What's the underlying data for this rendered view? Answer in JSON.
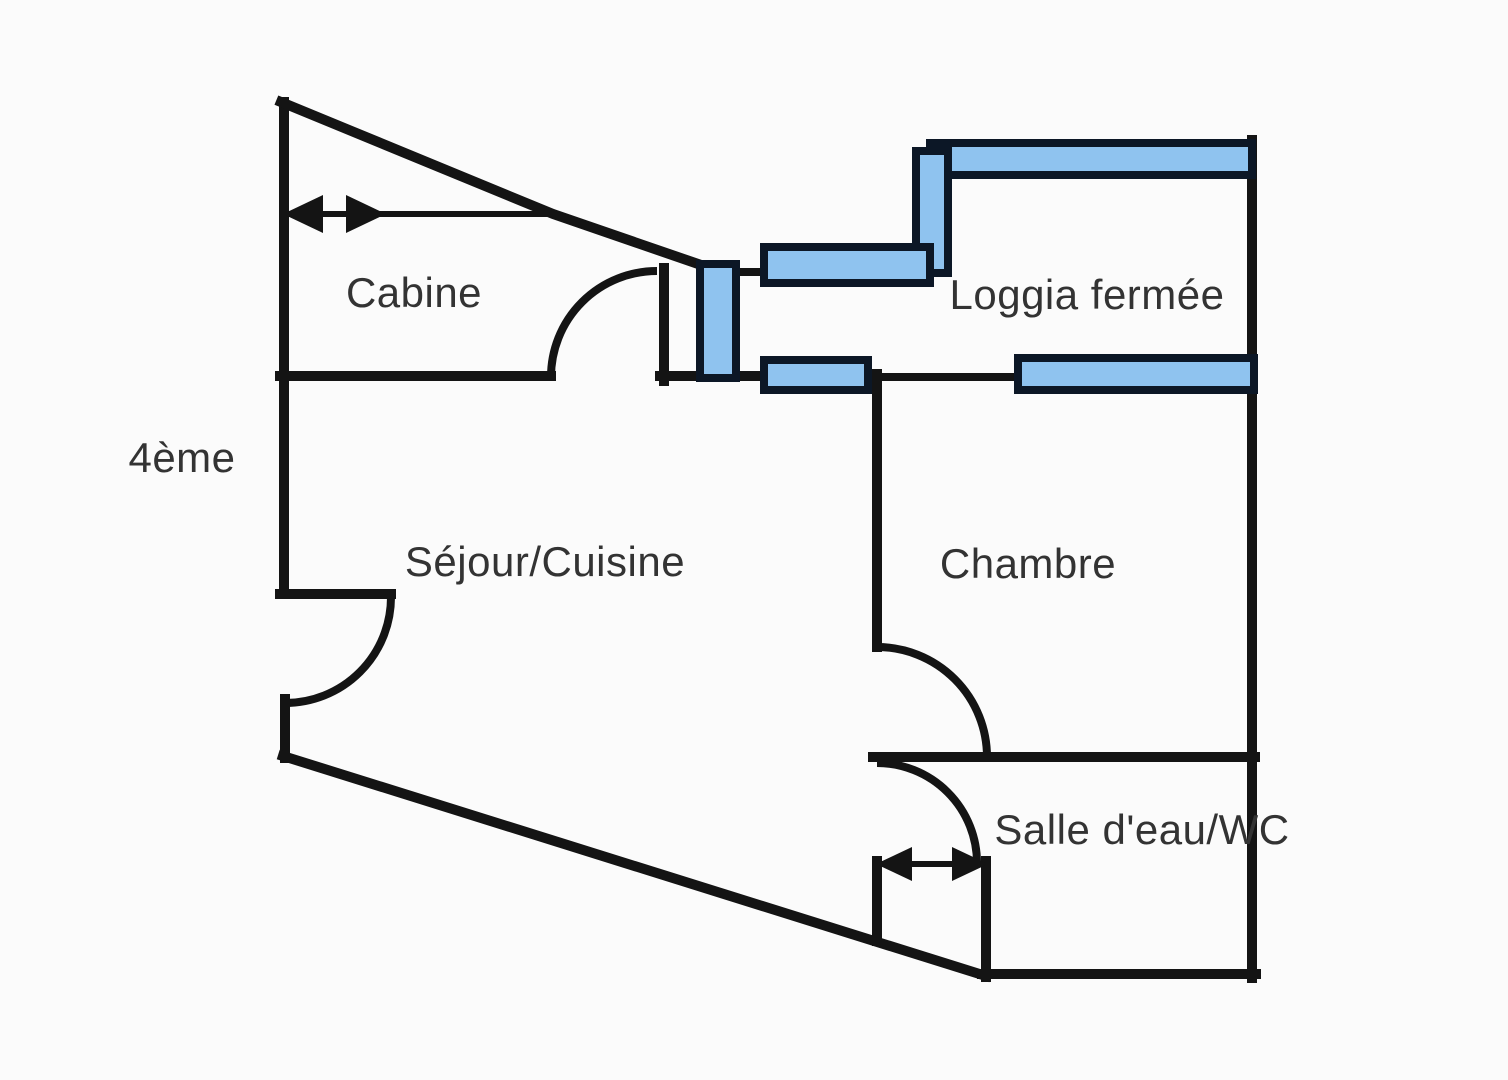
{
  "diagram": {
    "type": "floor-plan",
    "floor": {
      "label": "4ème"
    },
    "rooms": [
      {
        "id": "cabine",
        "label": "Cabine"
      },
      {
        "id": "loggia-fermee",
        "label": "Loggia fermée"
      },
      {
        "id": "sejour-cuisine",
        "label": "Séjour/Cuisine"
      },
      {
        "id": "chambre",
        "label": "Chambre"
      },
      {
        "id": "salle-eau-wc",
        "label": "Salle d'eau/WC"
      }
    ],
    "annotations": [
      {
        "id": "cabine-width-arrow",
        "type": "double-headed-dimension-arrow",
        "location": "top-left, inside Cabine slope"
      },
      {
        "id": "door-width-arrow",
        "type": "double-headed-dimension-arrow",
        "location": "above Salle d'eau door alcove"
      }
    ],
    "features": {
      "window_count": 6,
      "door_arc_count": 4
    },
    "colors": {
      "walls": "#141414",
      "window_fill": "#8fc3ef",
      "window_border": "#0c1726",
      "label_text": "#333333",
      "background": "#fbfbfb"
    }
  }
}
